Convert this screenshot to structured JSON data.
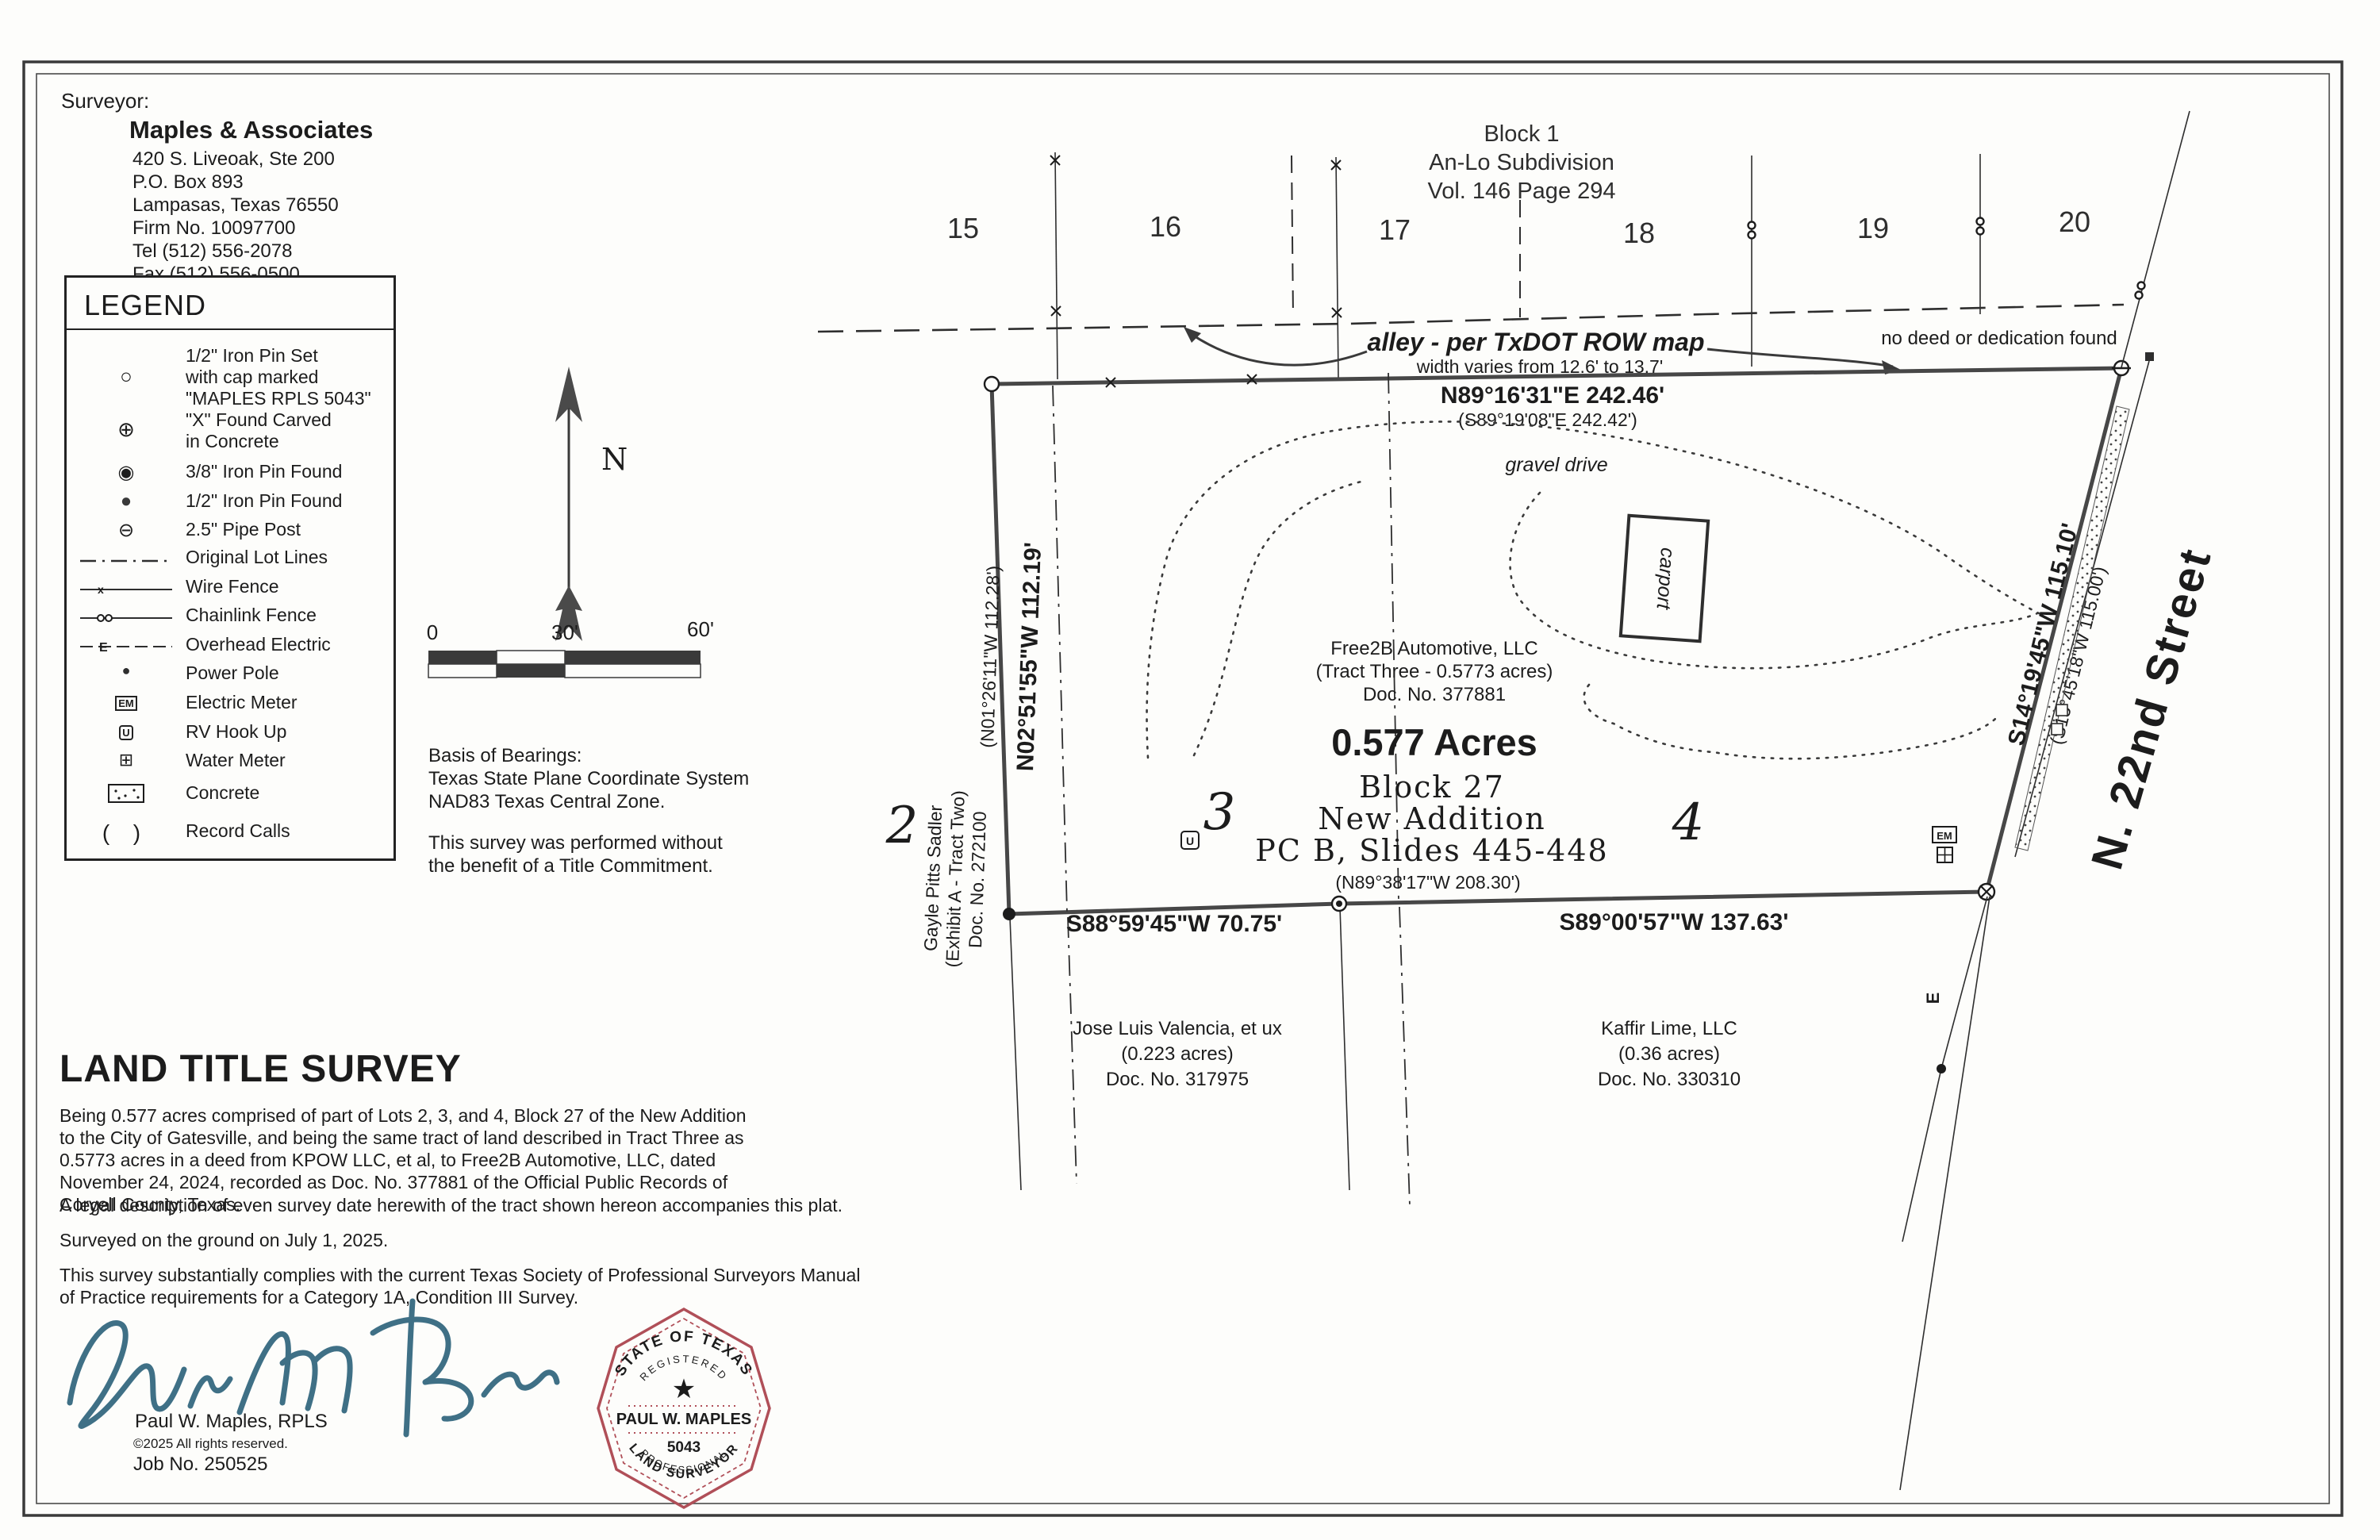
{
  "surveyor": {
    "label": "Surveyor:",
    "name": "Maples & Associates",
    "lines": "420 S. Liveoak, Ste 200\nP.O. Box 893\nLampasas, Texas 76550\nFirm No. 10097700\nTel  (512)  556-2078\nFax  (512)  556-0500"
  },
  "legend": {
    "title": "LEGEND",
    "items": [
      {
        "icon": "iron-pin-set",
        "label": "1/2\" Iron Pin Set\nwith cap marked\n\"MAPLES RPLS 5043\""
      },
      {
        "icon": "x-found-carved",
        "label": "\"X\" Found Carved\nin Concrete"
      },
      {
        "icon": "iron-pin-found-3-8",
        "label": "3/8\" Iron Pin Found"
      },
      {
        "icon": "iron-pin-found-1-2",
        "label": "1/2\" Iron Pin Found"
      },
      {
        "icon": "pipe-post",
        "label": "2.5\" Pipe Post"
      },
      {
        "icon": "original-lot-lines",
        "label": "Original Lot Lines"
      },
      {
        "icon": "wire-fence",
        "label": "Wire Fence"
      },
      {
        "icon": "chainlink-fence",
        "label": "Chainlink Fence"
      },
      {
        "icon": "overhead-electric",
        "label": "Overhead Electric"
      },
      {
        "icon": "power-pole",
        "label": "Power Pole"
      },
      {
        "icon": "electric-meter",
        "label": "Electric Meter"
      },
      {
        "icon": "rv-hook-up",
        "label": "RV Hook Up"
      },
      {
        "icon": "water-meter",
        "label": "Water Meter"
      },
      {
        "icon": "concrete",
        "label": "Concrete"
      },
      {
        "icon": "record-calls",
        "label": "Record Calls"
      }
    ]
  },
  "north_label": "N",
  "scalebar": {
    "t0": "0",
    "t30": "30'",
    "t60": "60'"
  },
  "notes": {
    "basis": "Basis of Bearings:\nTexas State Plane Coordinate System\nNAD83 Texas Central Zone.",
    "commitment": "This survey was performed without\nthe benefit of a Title Commitment."
  },
  "title_block": {
    "title": "LAND TITLE SURVEY",
    "p1": "Being 0.577 acres comprised of part of Lots 2, 3, and 4, Block 27 of the New Addition\nto the City of Gatesville, and being the same tract of land described in Tract Three as\n0.5773 acres in a deed from KPOW LLC, et al, to Free2B Automotive, LLC, dated\nNovember 24, 2024, recorded as Doc. No. 377881 of the Official Public Records of\nCoryell County, Texas.",
    "p2": "A legal description of even survey date herewith of the tract shown hereon accompanies this plat.",
    "p3": "Surveyed on the ground on July 1, 2025.",
    "p4": "This survey substantially complies with the current Texas Society of Professional Surveyors Manual\nof Practice requirements for a Category 1A, Condition III Survey."
  },
  "certification": {
    "name": "Paul W. Maples, RPLS",
    "copyright": "©2025 All rights reserved.",
    "job": "Job No. 250525"
  },
  "stamp": {
    "arc_top": "STATE OF TEXAS",
    "registered": "REGISTERED",
    "star": "★",
    "name": "PAUL W. MAPLES",
    "number": "5043",
    "professional": "PROFESSIONAL",
    "surveyor": "LAND SURVEYOR",
    "color": "#b04f58"
  },
  "signature_color": "#3f7086",
  "plat": {
    "subdivision": {
      "line1": "Block 1",
      "line2": "An-Lo Subdivision",
      "line3": "Vol. 146 Page 294"
    },
    "block1_lots": [
      "15",
      "16",
      "17",
      "18",
      "19",
      "20"
    ],
    "alley": {
      "label": "alley - per TxDOT ROW map",
      "width_note": "width varies from 12.6' to 13.7'",
      "no_deed": "no deed or dedication found"
    },
    "bearings": {
      "north": "N89°16'31\"E 242.46'",
      "north_record": "(S89°19'08\"E 242.42')",
      "west": "N02°51'55\"W 112.19'",
      "west_record": "(N01°26'11\"W 112.28')",
      "south_west": "S88°59'45\"W 70.75'",
      "south_record": "(N89°38'17\"W 208.30')",
      "south_east": "S89°00'57\"W 137.63'",
      "east": "S14°19'45\"W 115.10'",
      "east_record": "(S15°45'18\"W 115.00')"
    },
    "tract": {
      "owner": "Free2B Automotive, LLC",
      "note": "(Tract Three - 0.5773 acres)",
      "doc": "Doc. No. 377881",
      "acreage": "0.577 Acres",
      "block": "Block 27",
      "addition": "New Addition",
      "slides": "PC B, Slides 445-448"
    },
    "features": {
      "gravel_drive": "gravel drive",
      "carport": "carport"
    },
    "adjoiners": {
      "west": {
        "name": "Gayle Pitts Sadler",
        "note": "(Exhibit A - Tract Two)",
        "doc": "Doc. No. 272100"
      },
      "south1": {
        "name": "Jose Luis Valencia, et ux",
        "note": "(0.223 acres)",
        "doc": "Doc. No. 317975"
      },
      "south2": {
        "name": "Kaffir Lime, LLC",
        "note": "(0.36 acres)",
        "doc": "Doc. No. 330310"
      }
    },
    "block27_lots": [
      "2",
      "3",
      "4"
    ],
    "street": "N. 22nd Street",
    "symbols": {
      "em": "EM",
      "u": "U",
      "e": "E"
    }
  }
}
